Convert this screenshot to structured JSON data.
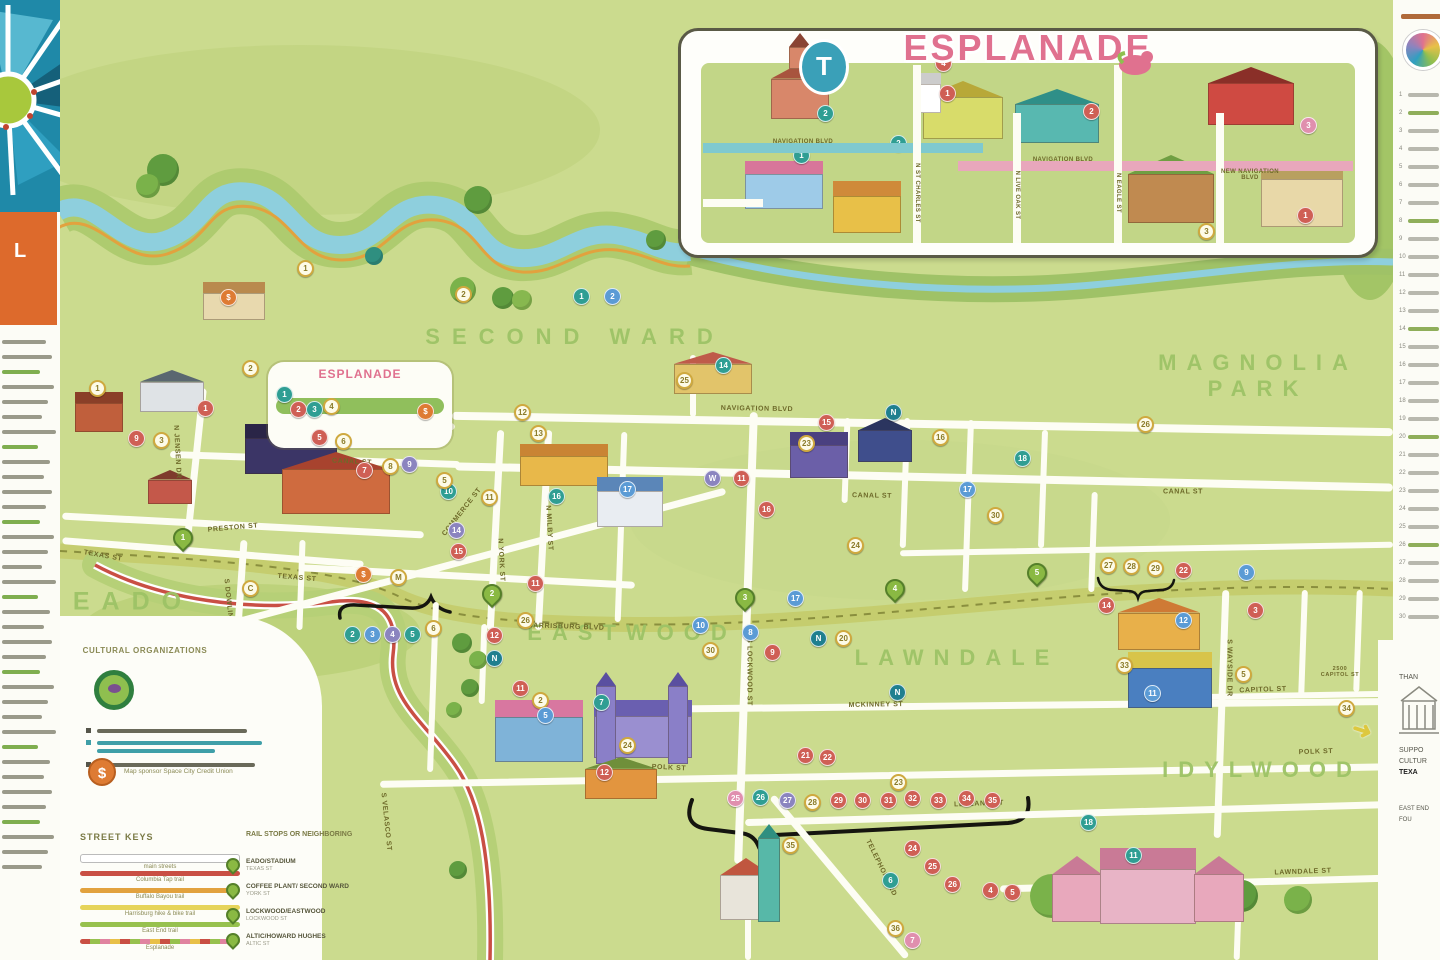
{
  "inset": {
    "title": "ESPLANADE",
    "badge": "T",
    "street_navigation_west": "NAVIGATION BLVD",
    "street_navigation_east": "NAVIGATION BLVD",
    "street_new_navigation": "NEW NAVIGATION\nBLVD",
    "vertical_streets": [
      "N ST CHARLES ST",
      "N LIVE OAK ST",
      "N EAGLE ST"
    ],
    "markers": [
      [
        798,
        152,
        "t",
        "1"
      ],
      [
        822,
        110,
        "t",
        "2"
      ],
      [
        944,
        90,
        "r",
        "1"
      ],
      [
        895,
        140,
        "t",
        "2"
      ],
      [
        1088,
        108,
        "r",
        "2"
      ],
      [
        1203,
        228,
        "g",
        "3"
      ],
      [
        1302,
        212,
        "r",
        "1"
      ],
      [
        1305,
        122,
        "k",
        "3"
      ],
      [
        940,
        60,
        "r",
        "4"
      ]
    ]
  },
  "map": {
    "neighborhoods": [
      {
        "label": "SECOND  WARD",
        "x": 575,
        "y": 337,
        "size": 22,
        "ls": 12
      },
      {
        "label": "MAGNOLIA\nPARK",
        "x": 1258,
        "y": 376,
        "size": 22,
        "ls": 10
      },
      {
        "label": "EADO",
        "x": 133,
        "y": 602,
        "size": 25,
        "ls": 12
      },
      {
        "label": "EASTWOOD",
        "x": 632,
        "y": 633,
        "size": 22,
        "ls": 10
      },
      {
        "label": "LAWNDALE",
        "x": 957,
        "y": 658,
        "size": 22,
        "ls": 10
      },
      {
        "label": "IDYLWOOD",
        "x": 1262,
        "y": 770,
        "size": 22,
        "ls": 10
      }
    ],
    "esplanade_rect_label": "ESPLANADE",
    "street_labels": [
      {
        "t": "NAVIGATION BLVD",
        "x": 757,
        "y": 409,
        "r": 1
      },
      {
        "t": "CANAL ST",
        "x": 352,
        "y": 462,
        "r": 3
      },
      {
        "t": "CANAL ST",
        "x": 872,
        "y": 496,
        "r": 1
      },
      {
        "t": "CANAL ST",
        "x": 1183,
        "y": 492,
        "r": 0
      },
      {
        "t": "COMMERCE ST",
        "x": 462,
        "y": 512,
        "r": -52
      },
      {
        "t": "PRESTON ST",
        "x": 233,
        "y": 528,
        "r": -5
      },
      {
        "t": "TEXAS ST",
        "x": 103,
        "y": 556,
        "r": 10
      },
      {
        "t": "TEXAS ST",
        "x": 297,
        "y": 578,
        "r": 5
      },
      {
        "t": "HARRISBURG BLVD",
        "x": 566,
        "y": 627,
        "r": 2
      },
      {
        "t": "MCKINNEY ST",
        "x": 876,
        "y": 705,
        "r": -1
      },
      {
        "t": "POLK ST",
        "x": 669,
        "y": 768,
        "r": 3
      },
      {
        "t": "POLK ST",
        "x": 1316,
        "y": 752,
        "r": -2
      },
      {
        "t": "LEELAND ST",
        "x": 979,
        "y": 804,
        "r": -2
      },
      {
        "t": "LAWNDALE ST",
        "x": 1303,
        "y": 872,
        "r": -2
      },
      {
        "t": "CAPITOL ST",
        "x": 1263,
        "y": 690,
        "r": -2
      },
      {
        "t": "2500\nCAPITOL ST",
        "x": 1340,
        "y": 672,
        "r": 0
      },
      {
        "t": "TELEPHONE RD",
        "x": 881,
        "y": 868,
        "r": 64
      },
      {
        "t": "S LOCKWOOD ST",
        "x": 749,
        "y": 672,
        "r": 90
      },
      {
        "t": "S WAYSIDE DR",
        "x": 1229,
        "y": 668,
        "r": 90
      },
      {
        "t": "S DOWLING ST",
        "x": 229,
        "y": 608,
        "r": 84
      },
      {
        "t": "N YORK ST",
        "x": 501,
        "y": 560,
        "r": 87
      },
      {
        "t": "N MILBY ST",
        "x": 549,
        "y": 528,
        "r": 87
      },
      {
        "t": "N JENSEN DR",
        "x": 177,
        "y": 452,
        "r": 87
      },
      {
        "t": "S VELASCO ST",
        "x": 386,
        "y": 822,
        "r": 84
      }
    ],
    "markers": [
      [
        305,
        268,
        "g",
        "1"
      ],
      [
        463,
        294,
        "g",
        "2"
      ],
      [
        581,
        296,
        "t",
        "1"
      ],
      [
        612,
        296,
        "b",
        "2"
      ],
      [
        228,
        297,
        "o",
        "$"
      ],
      [
        97,
        388,
        "g",
        "1"
      ],
      [
        205,
        408,
        "r",
        "1"
      ],
      [
        250,
        368,
        "g",
        "2"
      ],
      [
        136,
        438,
        "r",
        "9"
      ],
      [
        161,
        440,
        "g",
        "3"
      ],
      [
        284,
        394,
        "t",
        "1"
      ],
      [
        298,
        409,
        "r",
        "2"
      ],
      [
        314,
        409,
        "t",
        "3"
      ],
      [
        331,
        406,
        "g",
        "4"
      ],
      [
        425,
        411,
        "o",
        "$"
      ],
      [
        319,
        437,
        "r",
        "5"
      ],
      [
        343,
        441,
        "g",
        "6"
      ],
      [
        364,
        470,
        "r",
        "7"
      ],
      [
        390,
        466,
        "g",
        "8"
      ],
      [
        409,
        464,
        "p",
        "9"
      ],
      [
        448,
        491,
        "t",
        "10"
      ],
      [
        489,
        497,
        "g",
        "11"
      ],
      [
        522,
        412,
        "g",
        "12"
      ],
      [
        538,
        433,
        "g",
        "13"
      ],
      [
        444,
        480,
        "g",
        "5"
      ],
      [
        456,
        530,
        "p",
        "14"
      ],
      [
        458,
        551,
        "r",
        "15"
      ],
      [
        556,
        496,
        "t",
        "16"
      ],
      [
        627,
        489,
        "b",
        "17"
      ],
      [
        684,
        380,
        "g",
        "25"
      ],
      [
        723,
        365,
        "t",
        "14"
      ],
      [
        826,
        422,
        "r",
        "15"
      ],
      [
        806,
        443,
        "g",
        "23"
      ],
      [
        893,
        412,
        "n",
        "N"
      ],
      [
        940,
        437,
        "g",
        "16"
      ],
      [
        967,
        489,
        "b",
        "17"
      ],
      [
        995,
        515,
        "g",
        "30"
      ],
      [
        1022,
        458,
        "t",
        "18"
      ],
      [
        855,
        545,
        "g",
        "24"
      ],
      [
        1145,
        424,
        "g",
        "26"
      ],
      [
        712,
        478,
        "p",
        "W"
      ],
      [
        741,
        478,
        "r",
        "11"
      ],
      [
        766,
        509,
        "r",
        "16"
      ],
      [
        250,
        588,
        "g",
        "C"
      ],
      [
        363,
        574,
        "o",
        "$"
      ],
      [
        398,
        577,
        "g",
        "M"
      ],
      [
        352,
        634,
        "t",
        "2"
      ],
      [
        372,
        634,
        "b",
        "3"
      ],
      [
        392,
        634,
        "p",
        "4"
      ],
      [
        412,
        634,
        "t",
        "5"
      ],
      [
        433,
        628,
        "g",
        "6"
      ],
      [
        494,
        635,
        "r",
        "12"
      ],
      [
        494,
        658,
        "n",
        "N"
      ],
      [
        525,
        620,
        "g",
        "26"
      ],
      [
        535,
        583,
        "r",
        "11"
      ],
      [
        700,
        625,
        "b",
        "10"
      ],
      [
        710,
        650,
        "g",
        "30"
      ],
      [
        750,
        632,
        "b",
        "8"
      ],
      [
        772,
        652,
        "r",
        "9"
      ],
      [
        818,
        638,
        "n",
        "N"
      ],
      [
        843,
        638,
        "g",
        "20"
      ],
      [
        795,
        598,
        "b",
        "17"
      ],
      [
        1106,
        605,
        "r",
        "14"
      ],
      [
        1108,
        565,
        "g",
        "27"
      ],
      [
        1131,
        566,
        "g",
        "28"
      ],
      [
        1155,
        568,
        "g",
        "29"
      ],
      [
        1183,
        570,
        "r",
        "22"
      ],
      [
        1246,
        572,
        "b",
        "9"
      ],
      [
        897,
        692,
        "n",
        "N"
      ],
      [
        805,
        755,
        "r",
        "21"
      ],
      [
        827,
        757,
        "r",
        "22"
      ],
      [
        898,
        782,
        "g",
        "23"
      ],
      [
        520,
        688,
        "r",
        "11"
      ],
      [
        540,
        700,
        "g",
        "2"
      ],
      [
        601,
        702,
        "t",
        "7"
      ],
      [
        545,
        715,
        "b",
        "5"
      ],
      [
        604,
        772,
        "r",
        "12"
      ],
      [
        627,
        745,
        "g",
        "24"
      ],
      [
        735,
        798,
        "k",
        "25"
      ],
      [
        760,
        797,
        "t",
        "26"
      ],
      [
        787,
        800,
        "p",
        "27"
      ],
      [
        812,
        802,
        "g",
        "28"
      ],
      [
        838,
        800,
        "r",
        "29"
      ],
      [
        862,
        800,
        "r",
        "30"
      ],
      [
        888,
        800,
        "r",
        "31"
      ],
      [
        912,
        798,
        "r",
        "32"
      ],
      [
        938,
        800,
        "r",
        "33"
      ],
      [
        966,
        798,
        "r",
        "34"
      ],
      [
        992,
        800,
        "r",
        "35"
      ],
      [
        790,
        845,
        "g",
        "35"
      ],
      [
        912,
        848,
        "r",
        "24"
      ],
      [
        932,
        866,
        "r",
        "25"
      ],
      [
        952,
        884,
        "r",
        "26"
      ],
      [
        890,
        880,
        "t",
        "6"
      ],
      [
        895,
        928,
        "g",
        "36"
      ],
      [
        912,
        940,
        "k",
        "7"
      ],
      [
        990,
        890,
        "r",
        "4"
      ],
      [
        1012,
        892,
        "r",
        "5"
      ],
      [
        1088,
        822,
        "t",
        "18"
      ],
      [
        1133,
        855,
        "t",
        "11"
      ],
      [
        1255,
        610,
        "r",
        "3"
      ],
      [
        1124,
        665,
        "g",
        "33"
      ],
      [
        1243,
        674,
        "g",
        "5"
      ],
      [
        1346,
        708,
        "a",
        "34"
      ],
      [
        1183,
        620,
        "b",
        "12"
      ],
      [
        1152,
        693,
        "b",
        "11"
      ]
    ],
    "rail_pins": [
      [
        183,
        542,
        "1"
      ],
      [
        492,
        598,
        "2"
      ],
      [
        745,
        602,
        "3"
      ],
      [
        895,
        593,
        "4"
      ],
      [
        1037,
        577,
        "5"
      ]
    ]
  },
  "legend": {
    "org_heading": "CULTURAL\nORGANIZATIONS",
    "sponsor_text": "Map sponsor Space City Credit Union",
    "sponsor_symbol": "$",
    "street_keys_heading": "STREET KEYS",
    "keys": [
      {
        "label": "main streets",
        "type": "pill"
      },
      {
        "label": "Columbia Tap trail",
        "color": "#c94f44"
      },
      {
        "label": "Buffalo Bayou trail",
        "color": "#e2a23e"
      },
      {
        "label": "Harrisburg hike & bike trail",
        "color": "#e6d45a"
      },
      {
        "label": "East End trail",
        "color": "#97c14e"
      },
      {
        "label": "Esplanade",
        "type": "multi"
      }
    ],
    "rail_heading": "RAIL STOPS OR\nNEIGHBORING",
    "rail": [
      {
        "name": "EADO/STADIUM",
        "sub": "TEXAS ST"
      },
      {
        "name": "COFFEE PLANT/ SECOND WARD",
        "sub": "YORK ST"
      },
      {
        "name": "LOCKWOOD/EASTWOOD",
        "sub": "LOCKWOOD ST"
      },
      {
        "name": "ALTIC/HOWARD HUGHES",
        "sub": "ALTIC ST"
      }
    ]
  },
  "sidebars": {
    "logo_fragment": "L",
    "right_footer": [
      "THAN",
      "SUPPO",
      "CULTUR",
      "TEXA",
      "EAST END FOU"
    ]
  },
  "colors": {
    "map_bg": "#cbdb8e",
    "water": "#8ecfdd",
    "bank": "#aecb6f",
    "rail_band": "#c5cd6e",
    "marker_red": "#cf5f55",
    "marker_teal": "#2f9e93",
    "marker_blue": "#5b9bd5",
    "marker_purple": "#8b84bf",
    "marker_gold": "#cfa93f",
    "marker_orange": "#de7b33",
    "pin_green": "#8ab943",
    "title_pink": "#e0718f",
    "neighborhood_green": "#9dc366"
  }
}
